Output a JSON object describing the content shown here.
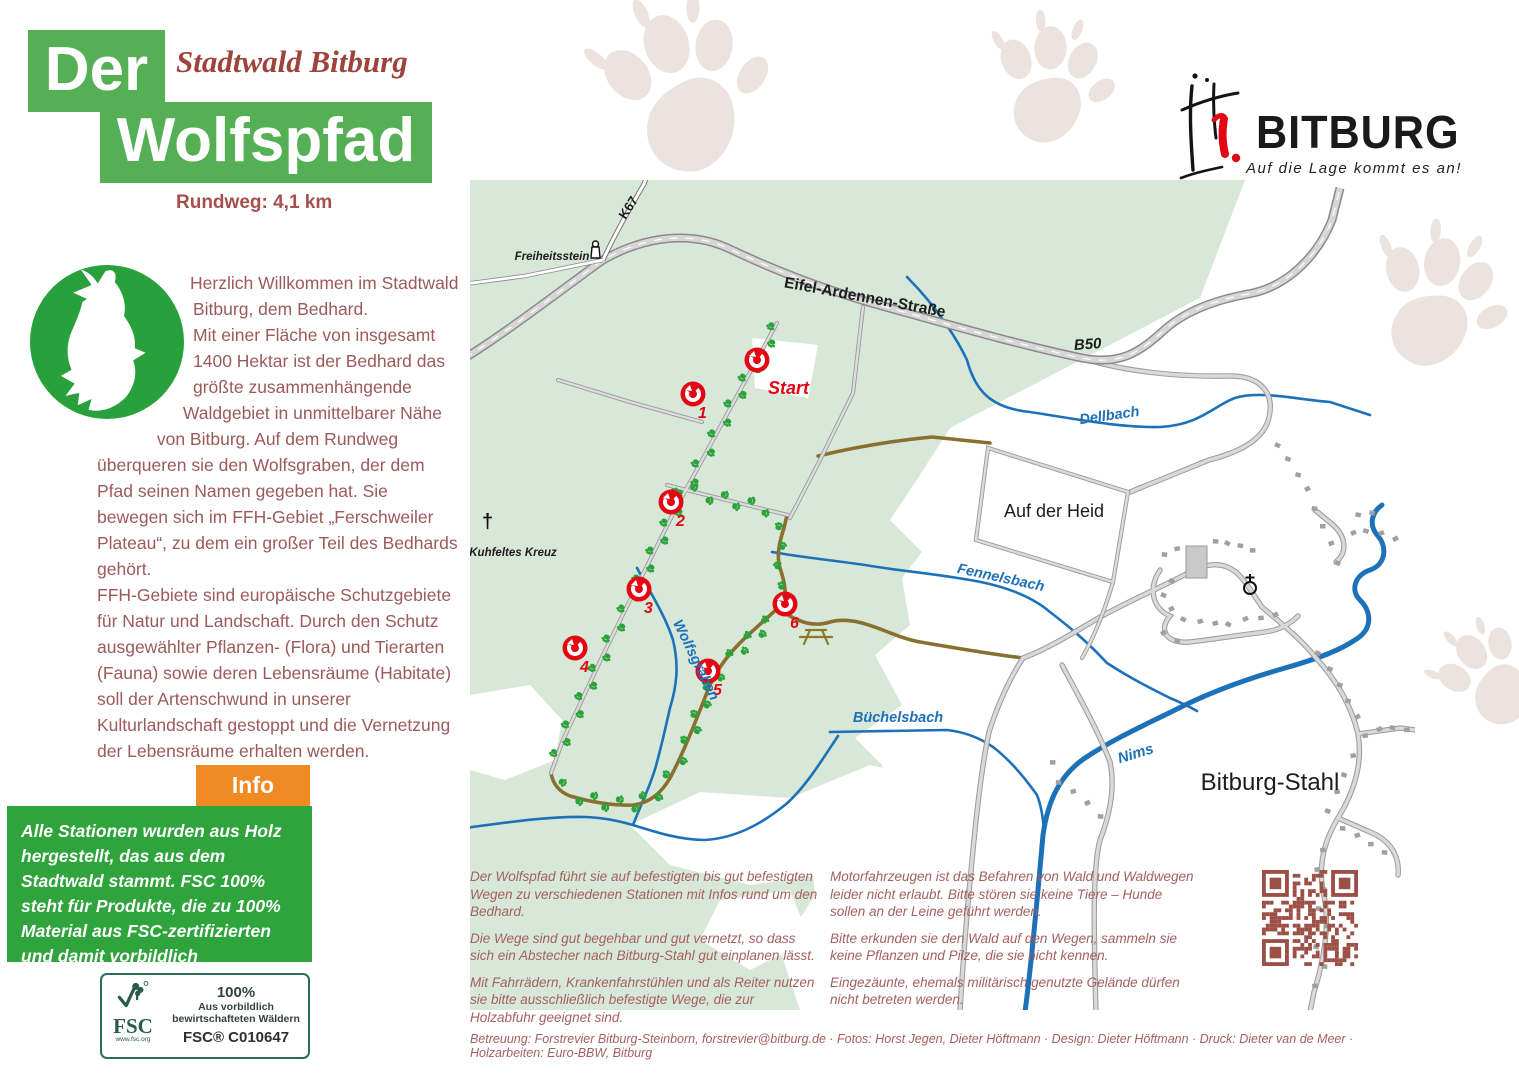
{
  "header": {
    "title_line1": "Der",
    "title_line2": "Wolfspfad",
    "subtitle": "Stadtwald Bitburg",
    "distance": "Rundweg: 4,1 km"
  },
  "intro": {
    "p1": "Herzlich Willkommen im Stadtwald Bitburg, dem Bedhard.",
    "p2": "Mit einer Fläche von insgesamt 1400 Hektar ist der Bedhard das größte zusammenhängende Waldgebiet in unmittelbarer Nähe von Bitburg. Auf dem Rundweg überqueren sie den Wolfsgraben, der dem Pfad seinen Namen gegeben hat. Sie bewegen sich im FFH-Gebiet „Ferschweiler Plateau“, zu dem ein großer Teil des Bedhards gehört.",
    "p3": "FFH-Gebiete sind europäische Schutzgebiete für Natur und Landschaft. Durch den Schutz ausgewählter Pflanzen- (Flora) und Tierarten (Fauna) sowie deren Lebensräume (Habitate) soll der Artenschwund in unserer Kulturlandschaft gestoppt und die Vernetzung der Lebensräume erhalten werden."
  },
  "info_box": {
    "tab": "Info",
    "text": "Alle Stationen wurden aus Holz hergestellt, das aus dem Stadtwald stammt. FSC 100% steht für Produkte, die zu 100% Material aus FSC-zertifizierten und damit vorbildlich bewirtschafteten Wäldern enthalten z. B. dem Bedhard."
  },
  "fsc": {
    "brand": "FSC",
    "url": "www.fsc.org",
    "percent": "100%",
    "line1": "Aus vorbildlich",
    "line2": "bewirtschafteten Wäldern",
    "code": "FSC® C010647"
  },
  "map": {
    "labels": {
      "freiheitsstein": "Freiheitsstein",
      "k67": "K67",
      "eifel_ardennen": "Eifel-Ardennen-Straße",
      "b50": "B50",
      "dellbach": "Dellbach",
      "fennelsbach": "Fennelsbach",
      "wolfsgraben": "Wolfsgraben",
      "buechelsbach": "Büchelsbach",
      "nims": "Nims",
      "auf_der_heid": "Auf der Heid",
      "bitburg_stahl": "Bitburg-Stahl",
      "kuhfeltes_kreuz": "Kuhfeltes Kreuz",
      "start": "Start"
    },
    "stations": [
      {
        "label": "1"
      },
      {
        "label": "2"
      },
      {
        "label": "3"
      },
      {
        "label": "4"
      },
      {
        "label": "5"
      },
      {
        "label": "6"
      }
    ]
  },
  "notes": {
    "col1": [
      "Der Wolfspfad führt sie auf befestigten bis gut befestigten Wegen zu verschiedenen Stationen mit Infos rund um den Bedhard.",
      "Die Wege sind gut begehbar und gut vernetzt, so dass sich ein Abstecher nach Bitburg-Stahl gut einplanen lässt.",
      "Mit Fahrrädern, Krankenfahrstühlen und als Reiter nutzen sie bitte ausschließlich befestigte Wege, die zur Holzabfuhr geeignet sind."
    ],
    "col2": [
      "Motorfahrzeugen ist das Befahren von Wald und Waldwegen leider nicht erlaubt. Bitte stören sie keine Tiere – Hunde sollen an der Leine geführt werden.",
      "Bitte erkunden sie den Wald auf den Wegen, sammeln sie keine Pflanzen und Pilze, die sie nicht kennen.",
      "Eingezäunte, ehemals militärisch genutzte Gelände dürfen nicht betreten werden."
    ]
  },
  "credits": "Betreuung: Forstrevier Bitburg-Steinborn, forstrevier@bitburg.de · Fotos: Horst Jegen, Dieter Höftmann · Design: Dieter Höftmann · Druck: Dieter van de Meer · Holzarbeiten: Euro-BBW, Bitburg",
  "brand": {
    "name": "BITBURG",
    "tagline": "Auf die Lage kommt es an!"
  },
  "colors": {
    "title_green": "#55af55",
    "logo_green": "#28a03c",
    "box_green": "#2fa33c",
    "orange": "#ef8b22",
    "body_red": "#9c5a5a",
    "accent_red": "#e30613",
    "forest": "#d8e8d8",
    "water": "#1d71b8",
    "path_brown": "#8a7030",
    "trail_paw_green": "#2ca23b",
    "qr_brown": "#9c4f45"
  }
}
